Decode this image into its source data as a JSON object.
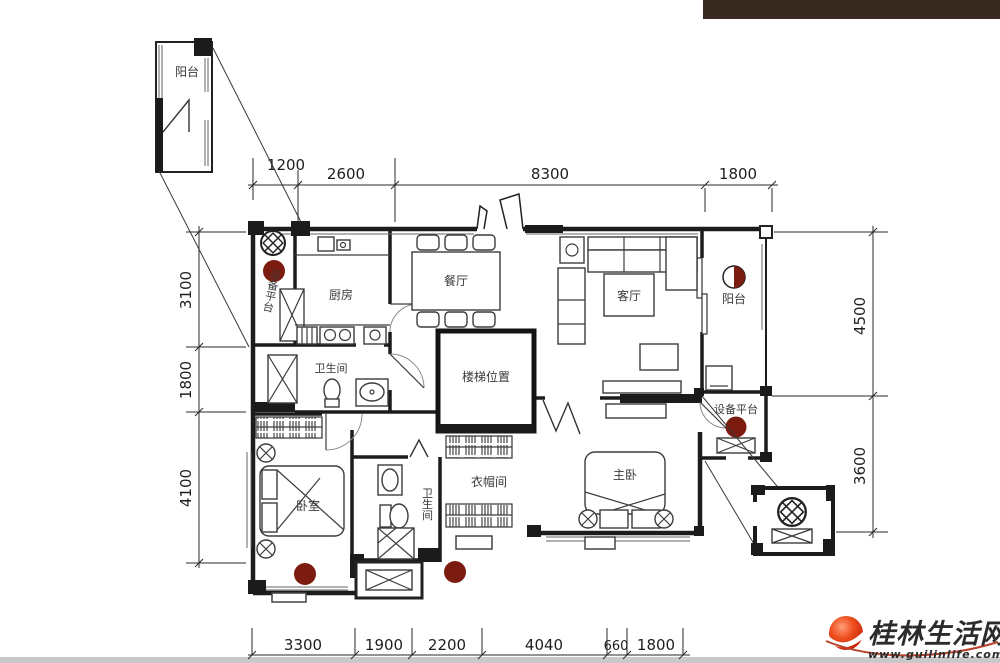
{
  "rooms": {
    "balcony_top": "阳台",
    "kitchen": "厨房",
    "dining": "餐厅",
    "living": "客厅",
    "balcony_right": "阳台",
    "equipment_left": "设备平台",
    "bathroom_main": "卫生间",
    "stairs": "楼梯位置",
    "closet": "衣帽间",
    "master_bedroom": "主卧",
    "bedroom": "卧室",
    "bathroom_second": "卫生间",
    "equipment_right": "设备平台"
  },
  "dimensions": {
    "top": [
      "1200",
      "2600",
      "8300",
      "1800"
    ],
    "left": [
      "3100",
      "1800",
      "4100"
    ],
    "right": [
      "4500",
      "3600"
    ],
    "bottom": [
      "3300",
      "1900",
      "2200",
      "4040",
      "660",
      "1800"
    ]
  },
  "watermark": {
    "site_name": "桂林生活网",
    "site_url": "www.guilinlife.com"
  },
  "colors": {
    "wall": "#1c1c1c",
    "marker": "#7c1c10",
    "header_bar": "#37291f",
    "logo_red": "#e23914",
    "watermark_text": "#333333",
    "url_text": "#111111",
    "bottom_bar": "#c9c9c9"
  }
}
